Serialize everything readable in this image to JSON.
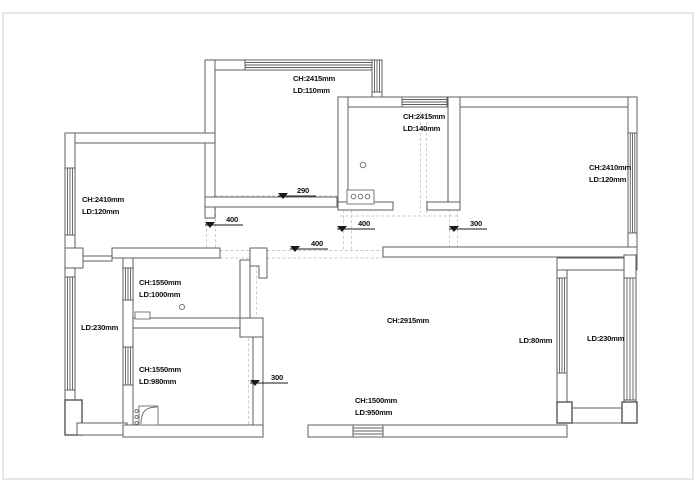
{
  "drawing": {
    "type": "ceiling-floor-plan",
    "rooms": {
      "top_room": {
        "ch": "CH:2415mm",
        "ld": "LD:110mm"
      },
      "kitchen": {
        "ch": "CH:2415mm",
        "ld": "LD:140mm"
      },
      "right_room": {
        "ch": "CH:2410mm",
        "ld": "LD:120mm"
      },
      "left_room": {
        "ch": "CH:2410mm",
        "ld": "LD:120mm"
      },
      "bath_upper": {
        "ch": "CH:1550mm",
        "ld": "LD:1000mm"
      },
      "balcony_left": {
        "ld": "LD:230mm"
      },
      "bath_lower": {
        "ch": "CH:1550mm",
        "ld": "LD:980mm"
      },
      "living": {
        "ch": "CH:2915mm"
      },
      "beam_right": {
        "ld": "LD:80mm"
      },
      "balcony_right": {
        "ld": "LD:230mm"
      },
      "entry_bottom": {
        "ch": "CH:1500mm",
        "ld": "LD:950mm"
      }
    },
    "markers": {
      "m290": "290",
      "m400_left": "400",
      "m400_right": "400",
      "m300_right": "300",
      "m400_mid": "400",
      "m300_bottom": "300"
    },
    "colors": {
      "wall": "#5f5f5f",
      "text": "#101010",
      "dash": "#c9c9c9",
      "frame": "#d6d6d6",
      "marker": "#1a1a1a",
      "background": "#ffffff"
    }
  }
}
